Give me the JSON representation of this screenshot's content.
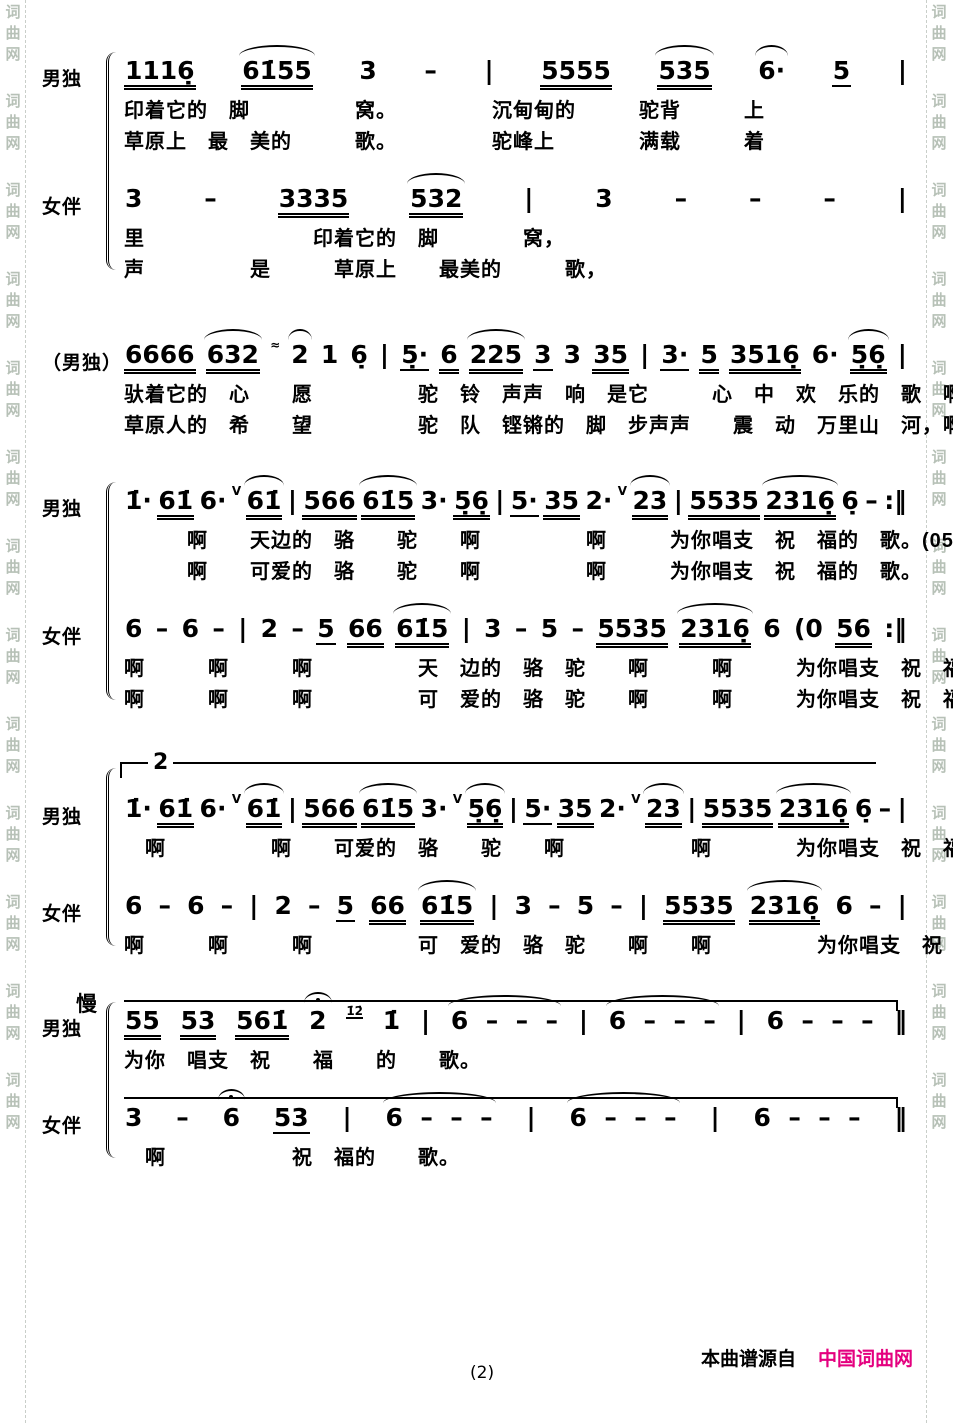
{
  "watermark": {
    "text": "词曲网",
    "color": "#b7c1b7",
    "border_color": "#c9cec9"
  },
  "footer": {
    "page_number": "(2)",
    "credit_prefix": "本曲谱源自",
    "credit_site": "中国词曲网",
    "site_color": "#e4007f"
  },
  "systems": [
    {
      "brace": true,
      "parts": [
        {
          "label": "男独",
          "notation": [
            {
              "t": "1116̣",
              "u": 2
            },
            {
              "t": "61̇55",
              "u": 2,
              "a": 1
            },
            {
              "t": "3"
            },
            {
              "t": "–"
            },
            {
              "t": "|"
            },
            {
              "t": "5555",
              "u": 2
            },
            {
              "t": "535",
              "u": 2,
              "a": 1
            },
            {
              "t": "6·",
              "a": 1
            },
            {
              "t": "5",
              "u": 1
            },
            {
              "t": "|"
            }
          ],
          "lyrics": [
            "印着它的　脚　　　　　窝。　　　　　沉甸甸的　　　驼背　　　上",
            "草原上　最　美的　　　歌。　　　　　驼峰上　　　　满载　　　着"
          ]
        },
        {
          "label": "女伴",
          "notation": [
            {
              "t": "3"
            },
            {
              "t": "–"
            },
            {
              "t": "3335",
              "u": 2
            },
            {
              "t": "532",
              "u": 2,
              "a": 1
            },
            {
              "t": "|"
            },
            {
              "t": "3"
            },
            {
              "t": "–"
            },
            {
              "t": "–"
            },
            {
              "t": "–"
            },
            {
              "t": "|"
            }
          ],
          "lyrics": [
            "里　　　　　　　　印着它的　脚　　　　窝，",
            "声　　　　　是　　　草原上　　最美的　　　歌，"
          ]
        }
      ]
    },
    {
      "brace": false,
      "parts": [
        {
          "label": "（男独）",
          "notation": [
            {
              "t": "6666",
              "u": 2
            },
            {
              "t": "632",
              "u": 2,
              "a": 1
            },
            {
              "t": "≈",
              "s": 1
            },
            {
              "t": "2",
              "a": 1
            },
            {
              "t": "1"
            },
            {
              "t": "6̣"
            },
            {
              "t": "|"
            },
            {
              "t": "5̣·",
              "u": 1
            },
            {
              "t": "6",
              "u": 2
            },
            {
              "t": "225",
              "u": 2,
              "a": 1
            },
            {
              "t": "3",
              "u": 1
            },
            {
              "t": "3"
            },
            {
              "t": "35",
              "u": 2
            },
            {
              "t": "|"
            },
            {
              "t": "3·",
              "u": 1
            },
            {
              "t": "5",
              "u": 2
            },
            {
              "t": "3516̣",
              "u": 2
            },
            {
              "t": "6·"
            },
            {
              "t": "5̣6̣",
              "u": 2,
              "a": 1
            },
            {
              "t": "|"
            }
          ],
          "lyrics": [
            "驮着它的　心　　愿　　　　　驼　铃　声声　响　是它　　　心　中　欢　乐的　歌　啊",
            "草原人的　希　　望　　　　　驼　队　铿锵的　脚　步声声　　震　动　万里山　河，啊"
          ]
        }
      ]
    },
    {
      "brace": true,
      "parts": [
        {
          "label": "男独",
          "notation": [
            {
              "t": "1̇·"
            },
            {
              "t": "61̇",
              "u": 2
            },
            {
              "t": "6·"
            },
            {
              "t": "V",
              "s": 1
            },
            {
              "t": "61̇",
              "u": 2,
              "a": 1
            },
            {
              "t": "|"
            },
            {
              "t": "566",
              "u": 2
            },
            {
              "t": "61̇5",
              "u": 2,
              "a": 1
            },
            {
              "t": "3·"
            },
            {
              "t": "5̣6̣",
              "u": 2
            },
            {
              "t": "|"
            },
            {
              "t": "5·",
              "u": 1
            },
            {
              "t": "35",
              "u": 2
            },
            {
              "t": "2·"
            },
            {
              "t": "V",
              "s": 1
            },
            {
              "t": "23",
              "u": 2,
              "a": 1
            },
            {
              "t": "|"
            },
            {
              "t": "5535",
              "u": 2
            },
            {
              "t": "2316̣",
              "u": 2,
              "a": 1
            },
            {
              "t": "6̣"
            },
            {
              "t": "–"
            },
            {
              "t": ":‖"
            }
          ],
          "lyrics": [
            "　　　啊　　天边的　骆　　驼　　啊　　　　　啊　　　为你唱支　祝　福的　歌。(056|",
            "　　　啊　　可爱的　骆　　驼　　啊　　　　　啊　　　为你唱支　祝　福的　歌。　　啊"
          ]
        },
        {
          "label": "女伴",
          "notation": [
            {
              "t": "6"
            },
            {
              "t": "–"
            },
            {
              "t": "6"
            },
            {
              "t": "–"
            },
            {
              "t": "|"
            },
            {
              "t": "2"
            },
            {
              "t": "–"
            },
            {
              "t": "5",
              "u": 1
            },
            {
              "t": "66",
              "u": 2
            },
            {
              "t": "61̇5",
              "u": 2,
              "a": 1
            },
            {
              "t": "|"
            },
            {
              "t": "3"
            },
            {
              "t": "–"
            },
            {
              "t": "5"
            },
            {
              "t": "–"
            },
            {
              "t": "5535",
              "u": 2
            },
            {
              "t": "2316̣",
              "u": 2,
              "a": 1
            },
            {
              "t": "6"
            },
            {
              "t": "(0"
            },
            {
              "t": "56",
              "u": 2
            },
            {
              "t": ":‖"
            }
          ],
          "lyrics": [
            "啊　　　啊　　　啊　　　　　天　边的　骆　驼　　啊　　　啊　　　为你唱支　祝　福的　歌。　　啊",
            "啊　　　啊　　　啊　　　　　可　爱的　骆　驼　　啊　　　啊　　　为你唱支　祝　福的　歌。　　啊"
          ]
        }
      ]
    },
    {
      "brace": true,
      "volta": "2",
      "parts": [
        {
          "label": "男独",
          "notation": [
            {
              "t": "1̇·"
            },
            {
              "t": "61̇",
              "u": 2
            },
            {
              "t": "6·"
            },
            {
              "t": "V",
              "s": 1
            },
            {
              "t": "61̇",
              "u": 2,
              "a": 1
            },
            {
              "t": "|"
            },
            {
              "t": "566",
              "u": 2
            },
            {
              "t": "61̇5",
              "u": 2,
              "a": 1
            },
            {
              "t": "3·"
            },
            {
              "t": "V",
              "s": 1
            },
            {
              "t": "5̣6̣",
              "u": 2,
              "a": 1
            },
            {
              "t": "|"
            },
            {
              "t": "5·",
              "u": 1
            },
            {
              "t": "35",
              "u": 2
            },
            {
              "t": "2·"
            },
            {
              "t": "V",
              "s": 1
            },
            {
              "t": "23",
              "u": 2,
              "a": 1
            },
            {
              "t": "|"
            },
            {
              "t": "5535",
              "u": 2
            },
            {
              "t": "2316̣",
              "u": 2,
              "a": 1
            },
            {
              "t": "6̣"
            },
            {
              "t": "–"
            },
            {
              "t": "|"
            }
          ],
          "lyrics": [
            "　啊　　　　　啊　　可爱的　骆　　驼　　啊　　　　　　啊　　　　为你唱支　祝　福的　歌。"
          ]
        },
        {
          "label": "女伴",
          "notation": [
            {
              "t": "6"
            },
            {
              "t": "–"
            },
            {
              "t": "6"
            },
            {
              "t": "–"
            },
            {
              "t": "|"
            },
            {
              "t": "2"
            },
            {
              "t": "–"
            },
            {
              "t": "5",
              "u": 1
            },
            {
              "t": "66",
              "u": 2
            },
            {
              "t": "61̇5",
              "u": 2,
              "a": 1
            },
            {
              "t": "|"
            },
            {
              "t": "3"
            },
            {
              "t": "–"
            },
            {
              "t": "5"
            },
            {
              "t": "–"
            },
            {
              "t": "|"
            },
            {
              "t": "5535",
              "u": 2
            },
            {
              "t": "2316̣",
              "u": 2,
              "a": 1
            },
            {
              "t": "6"
            },
            {
              "t": "–"
            },
            {
              "t": "|"
            }
          ],
          "lyrics": [
            "啊　　　啊　　　啊　　　　　可　爱的　骆　驼　　啊　　啊　　　　　为你唱支　祝　福的　歌。"
          ]
        }
      ]
    },
    {
      "brace": true,
      "tempo": "慢",
      "parts": [
        {
          "label": "男独",
          "topline": true,
          "notation": [
            {
              "t": "55",
              "u": 2
            },
            {
              "t": "53",
              "u": 2
            },
            {
              "t": "561̇",
              "u": 2
            },
            {
              "t": "2",
              "f": 1
            },
            {
              "t": "1̇2̇",
              "s": 1,
              "u": 1
            },
            {
              "t": "1̇"
            },
            {
              "t": "|"
            },
            {
              "t": "6  –  –  –",
              "a": 1
            },
            {
              "t": "|"
            },
            {
              "t": "6  –  –  –",
              "a": 1
            },
            {
              "t": "|"
            },
            {
              "t": "6  –  –  –"
            },
            {
              "t": "‖"
            }
          ],
          "lyrics": [
            "为你　唱支　祝　　福　　的　　歌。"
          ]
        },
        {
          "label": "女伴",
          "topline": true,
          "notation": [
            {
              "t": "3"
            },
            {
              "t": "–"
            },
            {
              "t": "6",
              "f": 1
            },
            {
              "t": "53",
              "u": 1
            },
            {
              "t": "|"
            },
            {
              "t": "6  –  –  –",
              "a": 1
            },
            {
              "t": "|"
            },
            {
              "t": "6  –  –  –",
              "a": 1
            },
            {
              "t": "|"
            },
            {
              "t": "6  –  –  –"
            },
            {
              "t": "‖"
            }
          ],
          "lyrics": [
            "　啊　　　　　　祝　福的　　歌。"
          ]
        }
      ]
    }
  ]
}
